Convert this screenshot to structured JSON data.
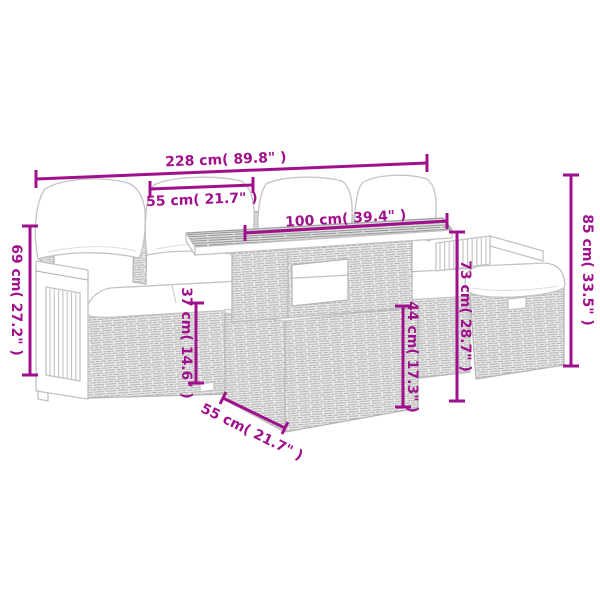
{
  "diagram": {
    "accent_color": "#A1108C",
    "artwork_line_color": "#C3C3C3",
    "background_color": "#FFFFFF",
    "dimensions": {
      "total_width": "228 cm( 89.8\" )",
      "seat_width": "55 cm( 21.7\" )",
      "tabletop_length": "100 cm( 39.4\" )",
      "total_height": "85 cm( 33.5\" )",
      "armrest_height": "69 cm( 27.2\" )",
      "seat_height": "37 cm( 14.6\" )",
      "table_base_height": "44 cm( 17.3\" )",
      "table_height": "73 cm( 28.7\" )",
      "table_depth": "55 cm( 21.7\" )"
    }
  }
}
